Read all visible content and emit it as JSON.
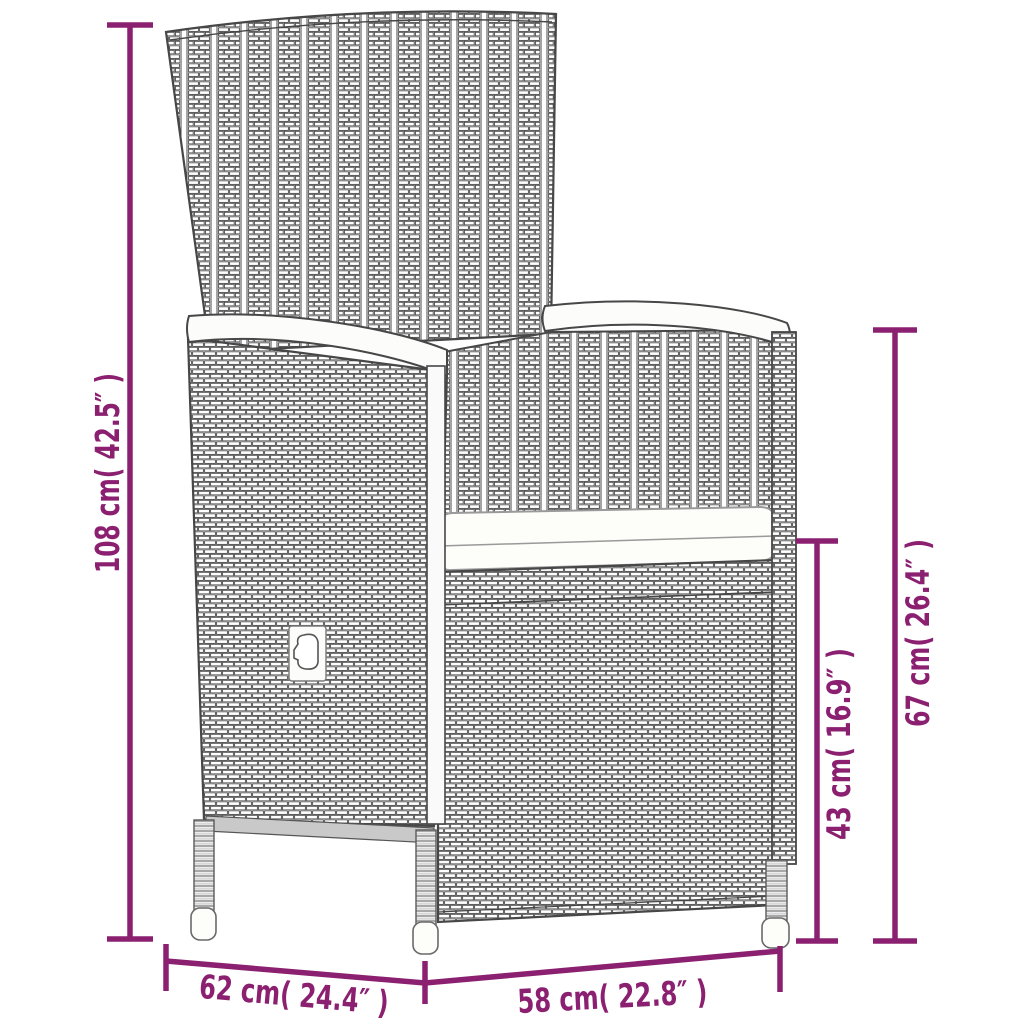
{
  "diagram": {
    "kind": "product dimension drawing",
    "subject": "poly rattan reclining garden chair with seat cushion",
    "accent_color": "#8b2071",
    "line_art_color": "#474747",
    "dimensions": {
      "overall_height": {
        "label": "108 cm( 42.5″ )",
        "cm": "108",
        "inches": "42.5",
        "side": "left",
        "orientation": "vertical"
      },
      "back_height": {
        "label": "67 cm( 26.4″ )",
        "cm": "67",
        "inches": "26.4",
        "side": "right-outer",
        "orientation": "vertical"
      },
      "seat_height": {
        "label": "43 cm( 16.9″ )",
        "cm": "43",
        "inches": "16.9",
        "side": "right-inner",
        "orientation": "vertical"
      },
      "depth": {
        "label": "62 cm( 24.4″ )",
        "cm": "62",
        "inches": "24.4",
        "side": "bottom-left",
        "orientation": "horizontal"
      },
      "width": {
        "label": "58 cm( 22.8″ )",
        "cm": "58",
        "inches": "22.8",
        "side": "bottom-right",
        "orientation": "horizontal"
      }
    }
  }
}
